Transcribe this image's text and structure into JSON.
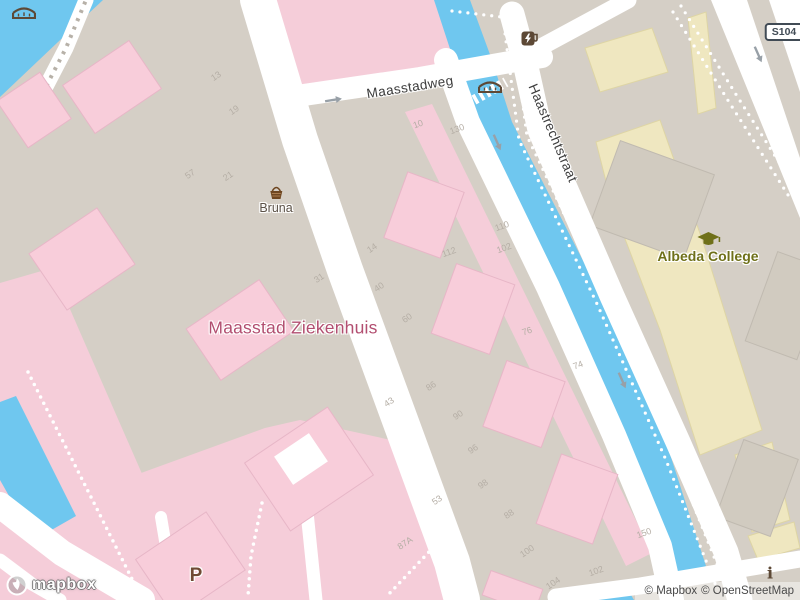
{
  "map": {
    "streets": {
      "maasstadweg": "Maasstadweg",
      "haastrechtstraat": "Haastrechtstraat"
    },
    "places": {
      "hospital": "Maasstad Ziekenhuis",
      "college": "Albeda College",
      "shop": "Bruna",
      "parking": "P",
      "road_shield": "S104",
      "info": "i"
    },
    "house_numbers": [
      {
        "value": "13"
      },
      {
        "value": "19"
      },
      {
        "value": "57"
      },
      {
        "value": "21"
      },
      {
        "value": "10"
      },
      {
        "value": "130"
      },
      {
        "value": "14"
      },
      {
        "value": "112"
      },
      {
        "value": "110"
      },
      {
        "value": "102"
      },
      {
        "value": "31"
      },
      {
        "value": "40"
      },
      {
        "value": "60"
      },
      {
        "value": "76"
      },
      {
        "value": "74"
      },
      {
        "value": "86"
      },
      {
        "value": "43"
      },
      {
        "value": "90"
      },
      {
        "value": "96"
      },
      {
        "value": "98"
      },
      {
        "value": "53"
      },
      {
        "value": "88"
      },
      {
        "value": "100"
      },
      {
        "value": "87A"
      },
      {
        "value": "104"
      },
      {
        "value": "102"
      },
      {
        "value": "150"
      }
    ],
    "attribution": {
      "mapbox": "© Mapbox",
      "osm": "© OpenStreetMap",
      "logo": "mapbox"
    },
    "colors": {
      "water": "#6fc7ef",
      "land": "#d5cfc6",
      "road": "#ffffff",
      "pink_ground": "#f5cdd9",
      "pink_building": "#f8cdda",
      "pink_stroke": "#e7b6c7",
      "yellow_building": "#efe7c0",
      "yellow_stroke": "#ded5a4",
      "gray_building": "#d1cbc0",
      "gray_stroke": "#c0bab0",
      "hospital_label": "#b24e70",
      "college_label": "#6f7019",
      "street_label": "#3d3d3d",
      "number_label": "#b5aea5",
      "poi_brown": "#5d4936",
      "shop_label": "#5c5248",
      "parking_label": "#6f4a33",
      "shield_color": "#414b55",
      "attribution_text": "#4a4a4a",
      "arrow": "#98a0a7"
    }
  }
}
